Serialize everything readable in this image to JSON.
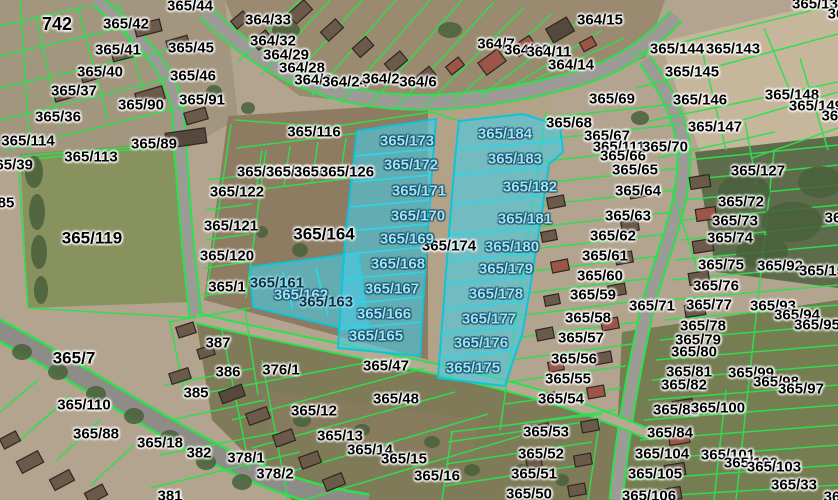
{
  "map": {
    "type": "cadastral-aerial-map",
    "colors": {
      "parcel_line": "#2ee04e",
      "highlight_fill": "#48cde8",
      "highlight_border": "#0fc4da",
      "label_black": "#000000",
      "label_cyan": "#a6e2f2",
      "label_dark": "#0d3147",
      "road": "#9d9b96",
      "background": "#b2a48e"
    },
    "highlighted_parcels": [
      "365/161",
      "365/162",
      "365/163",
      "365/165",
      "365/166",
      "365/167",
      "365/168",
      "365/169",
      "365/170",
      "365/171",
      "365/172",
      "365/173",
      "365/175",
      "365/176",
      "365/177",
      "365/178",
      "365/179",
      "365/180",
      "365/181",
      "365/182",
      "365/183",
      "365/184"
    ],
    "labels": [
      {
        "t": "742",
        "x": 57,
        "y": 24,
        "s": "b",
        "fs": 18
      },
      {
        "t": "365/42",
        "x": 126,
        "y": 24,
        "s": "b"
      },
      {
        "t": "365/44",
        "x": 190,
        "y": 6,
        "s": "b"
      },
      {
        "t": "364/33",
        "x": 268,
        "y": 20,
        "s": "b"
      },
      {
        "t": "365/41",
        "x": 118,
        "y": 50,
        "s": "b"
      },
      {
        "t": "365/45",
        "x": 191,
        "y": 48,
        "s": "b"
      },
      {
        "t": "364/32",
        "x": 273,
        "y": 41,
        "s": "b"
      },
      {
        "t": "364/29",
        "x": 286,
        "y": 55,
        "s": "b"
      },
      {
        "t": "364/28",
        "x": 302,
        "y": 68,
        "s": "b"
      },
      {
        "t": "364/3",
        "x": 313,
        "y": 80,
        "s": "b"
      },
      {
        "t": "364/24",
        "x": 345,
        "y": 82,
        "s": "b"
      },
      {
        "t": "364/2",
        "x": 381,
        "y": 79,
        "s": "b"
      },
      {
        "t": "364/6",
        "x": 418,
        "y": 82,
        "s": "b"
      },
      {
        "t": "364/7",
        "x": 496,
        "y": 44,
        "s": "b"
      },
      {
        "t": "364/10",
        "x": 527,
        "y": 50,
        "s": "b"
      },
      {
        "t": "364/11",
        "x": 549,
        "y": 52,
        "s": "b"
      },
      {
        "t": "364/14",
        "x": 571,
        "y": 65,
        "s": "b"
      },
      {
        "t": "364/15",
        "x": 600,
        "y": 20,
        "s": "b"
      },
      {
        "t": "365/144",
        "x": 677,
        "y": 49,
        "s": "b"
      },
      {
        "t": "365/143",
        "x": 733,
        "y": 49,
        "s": "b"
      },
      {
        "t": "365/13",
        "x": 815,
        "y": 4,
        "s": "b"
      },
      {
        "t": "36",
        "x": 836,
        "y": 14,
        "s": "b"
      },
      {
        "t": "365/145",
        "x": 692,
        "y": 72,
        "s": "b"
      },
      {
        "t": "365/146",
        "x": 700,
        "y": 100,
        "s": "b"
      },
      {
        "t": "365/147",
        "x": 715,
        "y": 127,
        "s": "b"
      },
      {
        "t": "365/148",
        "x": 792,
        "y": 95,
        "s": "b"
      },
      {
        "t": "365/149",
        "x": 816,
        "y": 106,
        "s": "b"
      },
      {
        "t": "365",
        "x": 834,
        "y": 116,
        "s": "b"
      },
      {
        "t": "365/40",
        "x": 100,
        "y": 72,
        "s": "b"
      },
      {
        "t": "365/37",
        "x": 74,
        "y": 91,
        "s": "b"
      },
      {
        "t": "365/36",
        "x": 58,
        "y": 117,
        "s": "b"
      },
      {
        "t": "365/90",
        "x": 141,
        "y": 105,
        "s": "b"
      },
      {
        "t": "365/91",
        "x": 202,
        "y": 100,
        "s": "b"
      },
      {
        "t": "365/46",
        "x": 193,
        "y": 76,
        "s": "b"
      },
      {
        "t": "365/89",
        "x": 154,
        "y": 144,
        "s": "b"
      },
      {
        "t": "365/69",
        "x": 612,
        "y": 99,
        "s": "b"
      },
      {
        "t": "365/68",
        "x": 569,
        "y": 123,
        "s": "b"
      },
      {
        "t": "365/67",
        "x": 607,
        "y": 136,
        "s": "b"
      },
      {
        "t": "365/111",
        "x": 619,
        "y": 147,
        "s": "b"
      },
      {
        "t": "365/66",
        "x": 623,
        "y": 156,
        "s": "b"
      },
      {
        "t": "365/65",
        "x": 635,
        "y": 170,
        "s": "b"
      },
      {
        "t": "365/70",
        "x": 665,
        "y": 147,
        "s": "b"
      },
      {
        "t": "365/64",
        "x": 638,
        "y": 191,
        "s": "b"
      },
      {
        "t": "365/63",
        "x": 628,
        "y": 216,
        "s": "b"
      },
      {
        "t": "365/62",
        "x": 613,
        "y": 236,
        "s": "b"
      },
      {
        "t": "365/61",
        "x": 605,
        "y": 256,
        "s": "b"
      },
      {
        "t": "365/60",
        "x": 600,
        "y": 276,
        "s": "b"
      },
      {
        "t": "365/59",
        "x": 593,
        "y": 295,
        "s": "b"
      },
      {
        "t": "365/58",
        "x": 588,
        "y": 318,
        "s": "b"
      },
      {
        "t": "365/57",
        "x": 581,
        "y": 338,
        "s": "b"
      },
      {
        "t": "365/56",
        "x": 574,
        "y": 359,
        "s": "b"
      },
      {
        "t": "365/55",
        "x": 568,
        "y": 379,
        "s": "b"
      },
      {
        "t": "365/54",
        "x": 561,
        "y": 399,
        "s": "b"
      },
      {
        "t": "365/53",
        "x": 546,
        "y": 432,
        "s": "b"
      },
      {
        "t": "365/52",
        "x": 541,
        "y": 454,
        "s": "b"
      },
      {
        "t": "365/51",
        "x": 534,
        "y": 474,
        "s": "b"
      },
      {
        "t": "365/50",
        "x": 529,
        "y": 494,
        "s": "b"
      },
      {
        "t": "365/127",
        "x": 758,
        "y": 171,
        "s": "b"
      },
      {
        "t": "36",
        "x": 833,
        "y": 218,
        "s": "b"
      },
      {
        "t": "365/72",
        "x": 741,
        "y": 202,
        "s": "b"
      },
      {
        "t": "365/73",
        "x": 735,
        "y": 221,
        "s": "b"
      },
      {
        "t": "365/74",
        "x": 730,
        "y": 238,
        "s": "b"
      },
      {
        "t": "365/75",
        "x": 721,
        "y": 265,
        "s": "b"
      },
      {
        "t": "365/92",
        "x": 780,
        "y": 266,
        "s": "b"
      },
      {
        "t": "365/15",
        "x": 822,
        "y": 271,
        "s": "b"
      },
      {
        "t": "365/76",
        "x": 716,
        "y": 286,
        "s": "b"
      },
      {
        "t": "365/77",
        "x": 709,
        "y": 305,
        "s": "b"
      },
      {
        "t": "365/71",
        "x": 652,
        "y": 306,
        "s": "b"
      },
      {
        "t": "365/93",
        "x": 773,
        "y": 306,
        "s": "b"
      },
      {
        "t": "365/94",
        "x": 797,
        "y": 315,
        "s": "b"
      },
      {
        "t": "365/95",
        "x": 817,
        "y": 325,
        "s": "b"
      },
      {
        "t": "365/78",
        "x": 703,
        "y": 326,
        "s": "b"
      },
      {
        "t": "365/79",
        "x": 698,
        "y": 340,
        "s": "b"
      },
      {
        "t": "365/80",
        "x": 694,
        "y": 352,
        "s": "b"
      },
      {
        "t": "365/81",
        "x": 689,
        "y": 372,
        "s": "b"
      },
      {
        "t": "365/82",
        "x": 684,
        "y": 385,
        "s": "b"
      },
      {
        "t": "365/99",
        "x": 751,
        "y": 373,
        "s": "b"
      },
      {
        "t": "365/98",
        "x": 776,
        "y": 382,
        "s": "b"
      },
      {
        "t": "365/97",
        "x": 801,
        "y": 389,
        "s": "b"
      },
      {
        "t": "365/83",
        "x": 676,
        "y": 410,
        "s": "b"
      },
      {
        "t": "365/100",
        "x": 718,
        "y": 408,
        "s": "b"
      },
      {
        "t": "365/84",
        "x": 670,
        "y": 433,
        "s": "b"
      },
      {
        "t": "365/104",
        "x": 662,
        "y": 454,
        "s": "b"
      },
      {
        "t": "365/101",
        "x": 728,
        "y": 455,
        "s": "b"
      },
      {
        "t": "365/102",
        "x": 751,
        "y": 463,
        "s": "b"
      },
      {
        "t": "365/103",
        "x": 774,
        "y": 467,
        "s": "b"
      },
      {
        "t": "365/105",
        "x": 655,
        "y": 474,
        "s": "b"
      },
      {
        "t": "365/33",
        "x": 794,
        "y": 485,
        "s": "b"
      },
      {
        "t": "365/106",
        "x": 649,
        "y": 496,
        "s": "b"
      },
      {
        "t": "36",
        "x": 832,
        "y": 497,
        "s": "b"
      },
      {
        "t": "365/114",
        "x": 28,
        "y": 141,
        "s": "b"
      },
      {
        "t": "365/113",
        "x": 91,
        "y": 157,
        "s": "b"
      },
      {
        "t": "365/39",
        "x": 10,
        "y": 165,
        "s": "b"
      },
      {
        "t": "85",
        "x": 6,
        "y": 203,
        "s": "b"
      },
      {
        "t": "365/119",
        "x": 92,
        "y": 238,
        "s": "b",
        "fs": 17
      },
      {
        "t": "365/122",
        "x": 237,
        "y": 192,
        "s": "b"
      },
      {
        "t": "365/121",
        "x": 231,
        "y": 226,
        "s": "b"
      },
      {
        "t": "365/120",
        "x": 227,
        "y": 256,
        "s": "b"
      },
      {
        "t": "365/1",
        "x": 227,
        "y": 287,
        "s": "b"
      },
      {
        "t": "365/123",
        "x": 264,
        "y": 172,
        "s": "b"
      },
      {
        "t": "365/124",
        "x": 293,
        "y": 172,
        "s": "b"
      },
      {
        "t": "365/125",
        "x": 321,
        "y": 172,
        "s": "b"
      },
      {
        "t": "365/126",
        "x": 347,
        "y": 172,
        "s": "b"
      },
      {
        "t": "365/116",
        "x": 314,
        "y": 132,
        "s": "b"
      },
      {
        "t": "365/164",
        "x": 324,
        "y": 234,
        "s": "b",
        "fs": 17
      },
      {
        "t": "365/174",
        "x": 449,
        "y": 246,
        "s": "b"
      },
      {
        "t": "365/47",
        "x": 386,
        "y": 366,
        "s": "b"
      },
      {
        "t": "365/48",
        "x": 396,
        "y": 399,
        "s": "b"
      },
      {
        "t": "365/12",
        "x": 314,
        "y": 411,
        "s": "b"
      },
      {
        "t": "365/13",
        "x": 340,
        "y": 436,
        "s": "b"
      },
      {
        "t": "365/14",
        "x": 370,
        "y": 450,
        "s": "b"
      },
      {
        "t": "365/15",
        "x": 404,
        "y": 459,
        "s": "b"
      },
      {
        "t": "365/16",
        "x": 437,
        "y": 476,
        "s": "b"
      },
      {
        "t": "376/1",
        "x": 281,
        "y": 370,
        "s": "b"
      },
      {
        "t": "365/7",
        "x": 74,
        "y": 358,
        "s": "b",
        "fs": 17
      },
      {
        "t": "365/110",
        "x": 84,
        "y": 405,
        "s": "b"
      },
      {
        "t": "365/88",
        "x": 96,
        "y": 434,
        "s": "b"
      },
      {
        "t": "365/18",
        "x": 160,
        "y": 443,
        "s": "b"
      },
      {
        "t": "387",
        "x": 218,
        "y": 343,
        "s": "b"
      },
      {
        "t": "386",
        "x": 228,
        "y": 372,
        "s": "b"
      },
      {
        "t": "385",
        "x": 196,
        "y": 393,
        "s": "b"
      },
      {
        "t": "382",
        "x": 199,
        "y": 453,
        "s": "b"
      },
      {
        "t": "378/1",
        "x": 246,
        "y": 458,
        "s": "b"
      },
      {
        "t": "378/2",
        "x": 275,
        "y": 474,
        "s": "b"
      },
      {
        "t": "381",
        "x": 170,
        "y": 496,
        "s": "b"
      },
      {
        "t": "365/173",
        "x": 407,
        "y": 141,
        "s": "c"
      },
      {
        "t": "365/184",
        "x": 505,
        "y": 134,
        "s": "c"
      },
      {
        "t": "365/183",
        "x": 515,
        "y": 159,
        "s": "c"
      },
      {
        "t": "365/172",
        "x": 411,
        "y": 165,
        "s": "c"
      },
      {
        "t": "365/171",
        "x": 419,
        "y": 191,
        "s": "c"
      },
      {
        "t": "365/182",
        "x": 530,
        "y": 187,
        "s": "c"
      },
      {
        "t": "365/170",
        "x": 418,
        "y": 216,
        "s": "c"
      },
      {
        "t": "365/181",
        "x": 525,
        "y": 219,
        "s": "c"
      },
      {
        "t": "365/169",
        "x": 407,
        "y": 239,
        "s": "c"
      },
      {
        "t": "365/180",
        "x": 512,
        "y": 247,
        "s": "c"
      },
      {
        "t": "365/168",
        "x": 398,
        "y": 264,
        "s": "c"
      },
      {
        "t": "365/179",
        "x": 506,
        "y": 269,
        "s": "c"
      },
      {
        "t": "365/167",
        "x": 392,
        "y": 289,
        "s": "c"
      },
      {
        "t": "365/178",
        "x": 496,
        "y": 294,
        "s": "c"
      },
      {
        "t": "365/166",
        "x": 384,
        "y": 314,
        "s": "c"
      },
      {
        "t": "365/177",
        "x": 489,
        "y": 319,
        "s": "c"
      },
      {
        "t": "365/165",
        "x": 376,
        "y": 336,
        "s": "c"
      },
      {
        "t": "365/176",
        "x": 481,
        "y": 343,
        "s": "c"
      },
      {
        "t": "365/175",
        "x": 473,
        "y": 368,
        "s": "c"
      },
      {
        "t": "365/162",
        "x": 301,
        "y": 295,
        "s": "c"
      },
      {
        "t": "365/161",
        "x": 277,
        "y": 283,
        "s": "d"
      },
      {
        "t": "365/163",
        "x": 326,
        "y": 302,
        "s": "d"
      }
    ]
  }
}
